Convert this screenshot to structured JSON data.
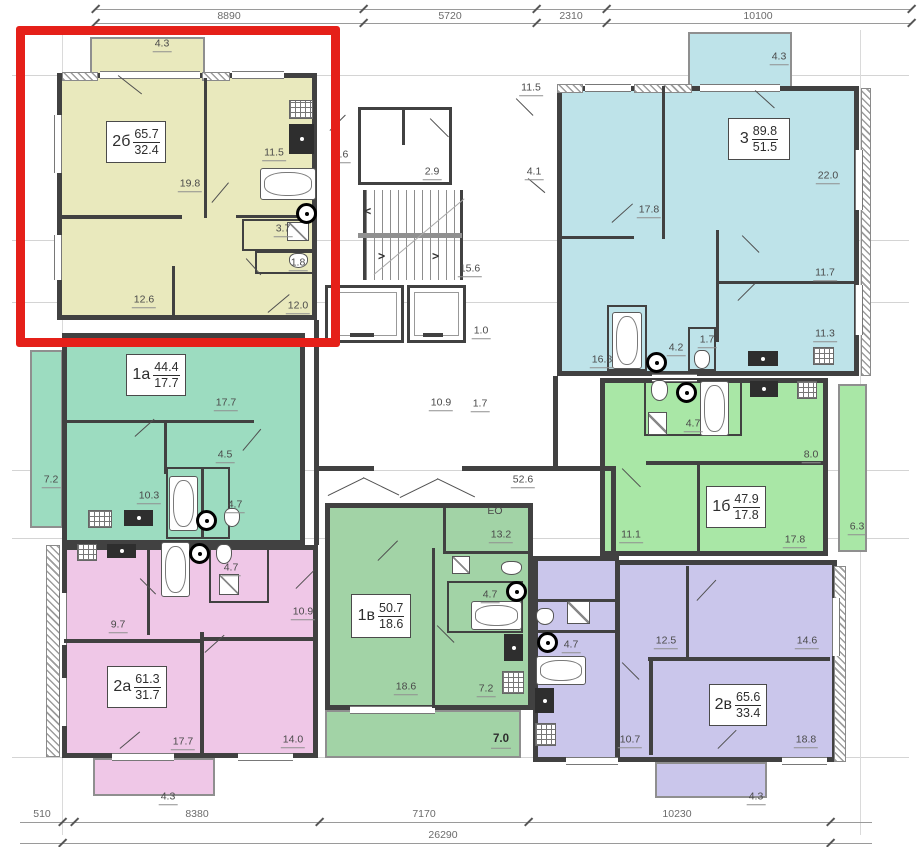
{
  "dimensions": {
    "top": [
      "8890",
      "5720",
      "2310",
      "10100"
    ],
    "bottom": [
      "510",
      "8380",
      "7170",
      "10230"
    ],
    "total": "26290"
  },
  "highlight_color": "#e52019",
  "apartments": [
    {
      "id": "2b",
      "type": "2б",
      "area_total": "65.7",
      "area_living": "32.4",
      "color": "#e9e9bd",
      "highlighted": true,
      "rooms": [
        {
          "name": "balcony",
          "area": "4.3"
        },
        {
          "name": "living-room",
          "area": "19.8"
        },
        {
          "name": "kitchen",
          "area": "11.5"
        },
        {
          "name": "bathroom",
          "area": "3.7"
        },
        {
          "name": "wc",
          "area": "1.8"
        },
        {
          "name": "bedroom-1",
          "area": "12.6"
        },
        {
          "name": "bedroom-2",
          "area": "12.0"
        }
      ]
    },
    {
      "id": "3",
      "type": "3",
      "area_total": "89.8",
      "area_living": "51.5",
      "color": "#bee3e9",
      "highlighted": false,
      "rooms": [
        {
          "name": "balcony",
          "area": "4.3"
        },
        {
          "name": "kitchen",
          "area": "11.5"
        },
        {
          "name": "living-room",
          "area": "22.0"
        },
        {
          "name": "bedroom-1",
          "area": "17.8"
        },
        {
          "name": "hall",
          "area": "4.1"
        },
        {
          "name": "bedroom-2",
          "area": "11.7"
        },
        {
          "name": "bedroom-3",
          "area": "11.3"
        },
        {
          "name": "corridor",
          "area": "16.8"
        },
        {
          "name": "bathroom",
          "area": "4.2"
        },
        {
          "name": "wc",
          "area": "1.7"
        }
      ]
    },
    {
      "id": "1a",
      "type": "1а",
      "area_total": "44.4",
      "area_living": "17.7",
      "color": "#9cdcc0",
      "highlighted": false,
      "rooms": [
        {
          "name": "living-room",
          "area": "17.7"
        },
        {
          "name": "hall",
          "area": "4.5"
        },
        {
          "name": "kitchen",
          "area": "10.3"
        },
        {
          "name": "bathroom",
          "area": "4.7"
        },
        {
          "name": "balcony",
          "area": "7.2"
        }
      ]
    },
    {
      "id": "1b",
      "type": "1б",
      "area_total": "47.9",
      "area_living": "17.8",
      "color": "#a9e7a6",
      "highlighted": false,
      "rooms": [
        {
          "name": "bathroom",
          "area": "4.7"
        },
        {
          "name": "hall",
          "area": "8.0"
        },
        {
          "name": "kitchen",
          "area": "11.1"
        },
        {
          "name": "living-room",
          "area": "17.8"
        },
        {
          "name": "balcony",
          "area": "6.3"
        }
      ]
    },
    {
      "id": "2a",
      "type": "2а",
      "area_total": "61.3",
      "area_living": "31.7",
      "color": "#efc7e7",
      "highlighted": false,
      "rooms": [
        {
          "name": "kitchen",
          "area": "9.7"
        },
        {
          "name": "bathroom",
          "area": "4.7"
        },
        {
          "name": "bedroom-1",
          "area": "10.9"
        },
        {
          "name": "living-room",
          "area": "17.7"
        },
        {
          "name": "bedroom-2",
          "area": "14.0"
        },
        {
          "name": "balcony",
          "area": "4.3"
        }
      ]
    },
    {
      "id": "1v",
      "type": "1в",
      "area_total": "50.7",
      "area_living": "18.6",
      "color": "#a2d3a6",
      "highlighted": false,
      "note": "ЕО",
      "rooms": [
        {
          "name": "kitchen",
          "area": "13.2"
        },
        {
          "name": "bathroom",
          "area": "4.7"
        },
        {
          "name": "living-room",
          "area": "18.6"
        },
        {
          "name": "hall",
          "area": "7.2"
        },
        {
          "name": "balcony",
          "area": "7.0"
        }
      ]
    },
    {
      "id": "2v",
      "type": "2в",
      "area_total": "65.6",
      "area_living": "33.4",
      "color": "#cac6eb",
      "highlighted": false,
      "rooms": [
        {
          "name": "bathroom",
          "area": "4.7"
        },
        {
          "name": "bedroom-1",
          "area": "12.5"
        },
        {
          "name": "bedroom-2",
          "area": "14.6"
        },
        {
          "name": "kitchen",
          "area": "10.7"
        },
        {
          "name": "living-room",
          "area": "18.8"
        },
        {
          "name": "balcony",
          "area": "4.3"
        }
      ]
    }
  ],
  "core": {
    "vestibule": "2.6",
    "elevator_hall": "2.9",
    "stairs": "15.6",
    "shaft": "1.0",
    "lobby": "10.9",
    "duct": "1.7",
    "corridor": "52.6"
  }
}
